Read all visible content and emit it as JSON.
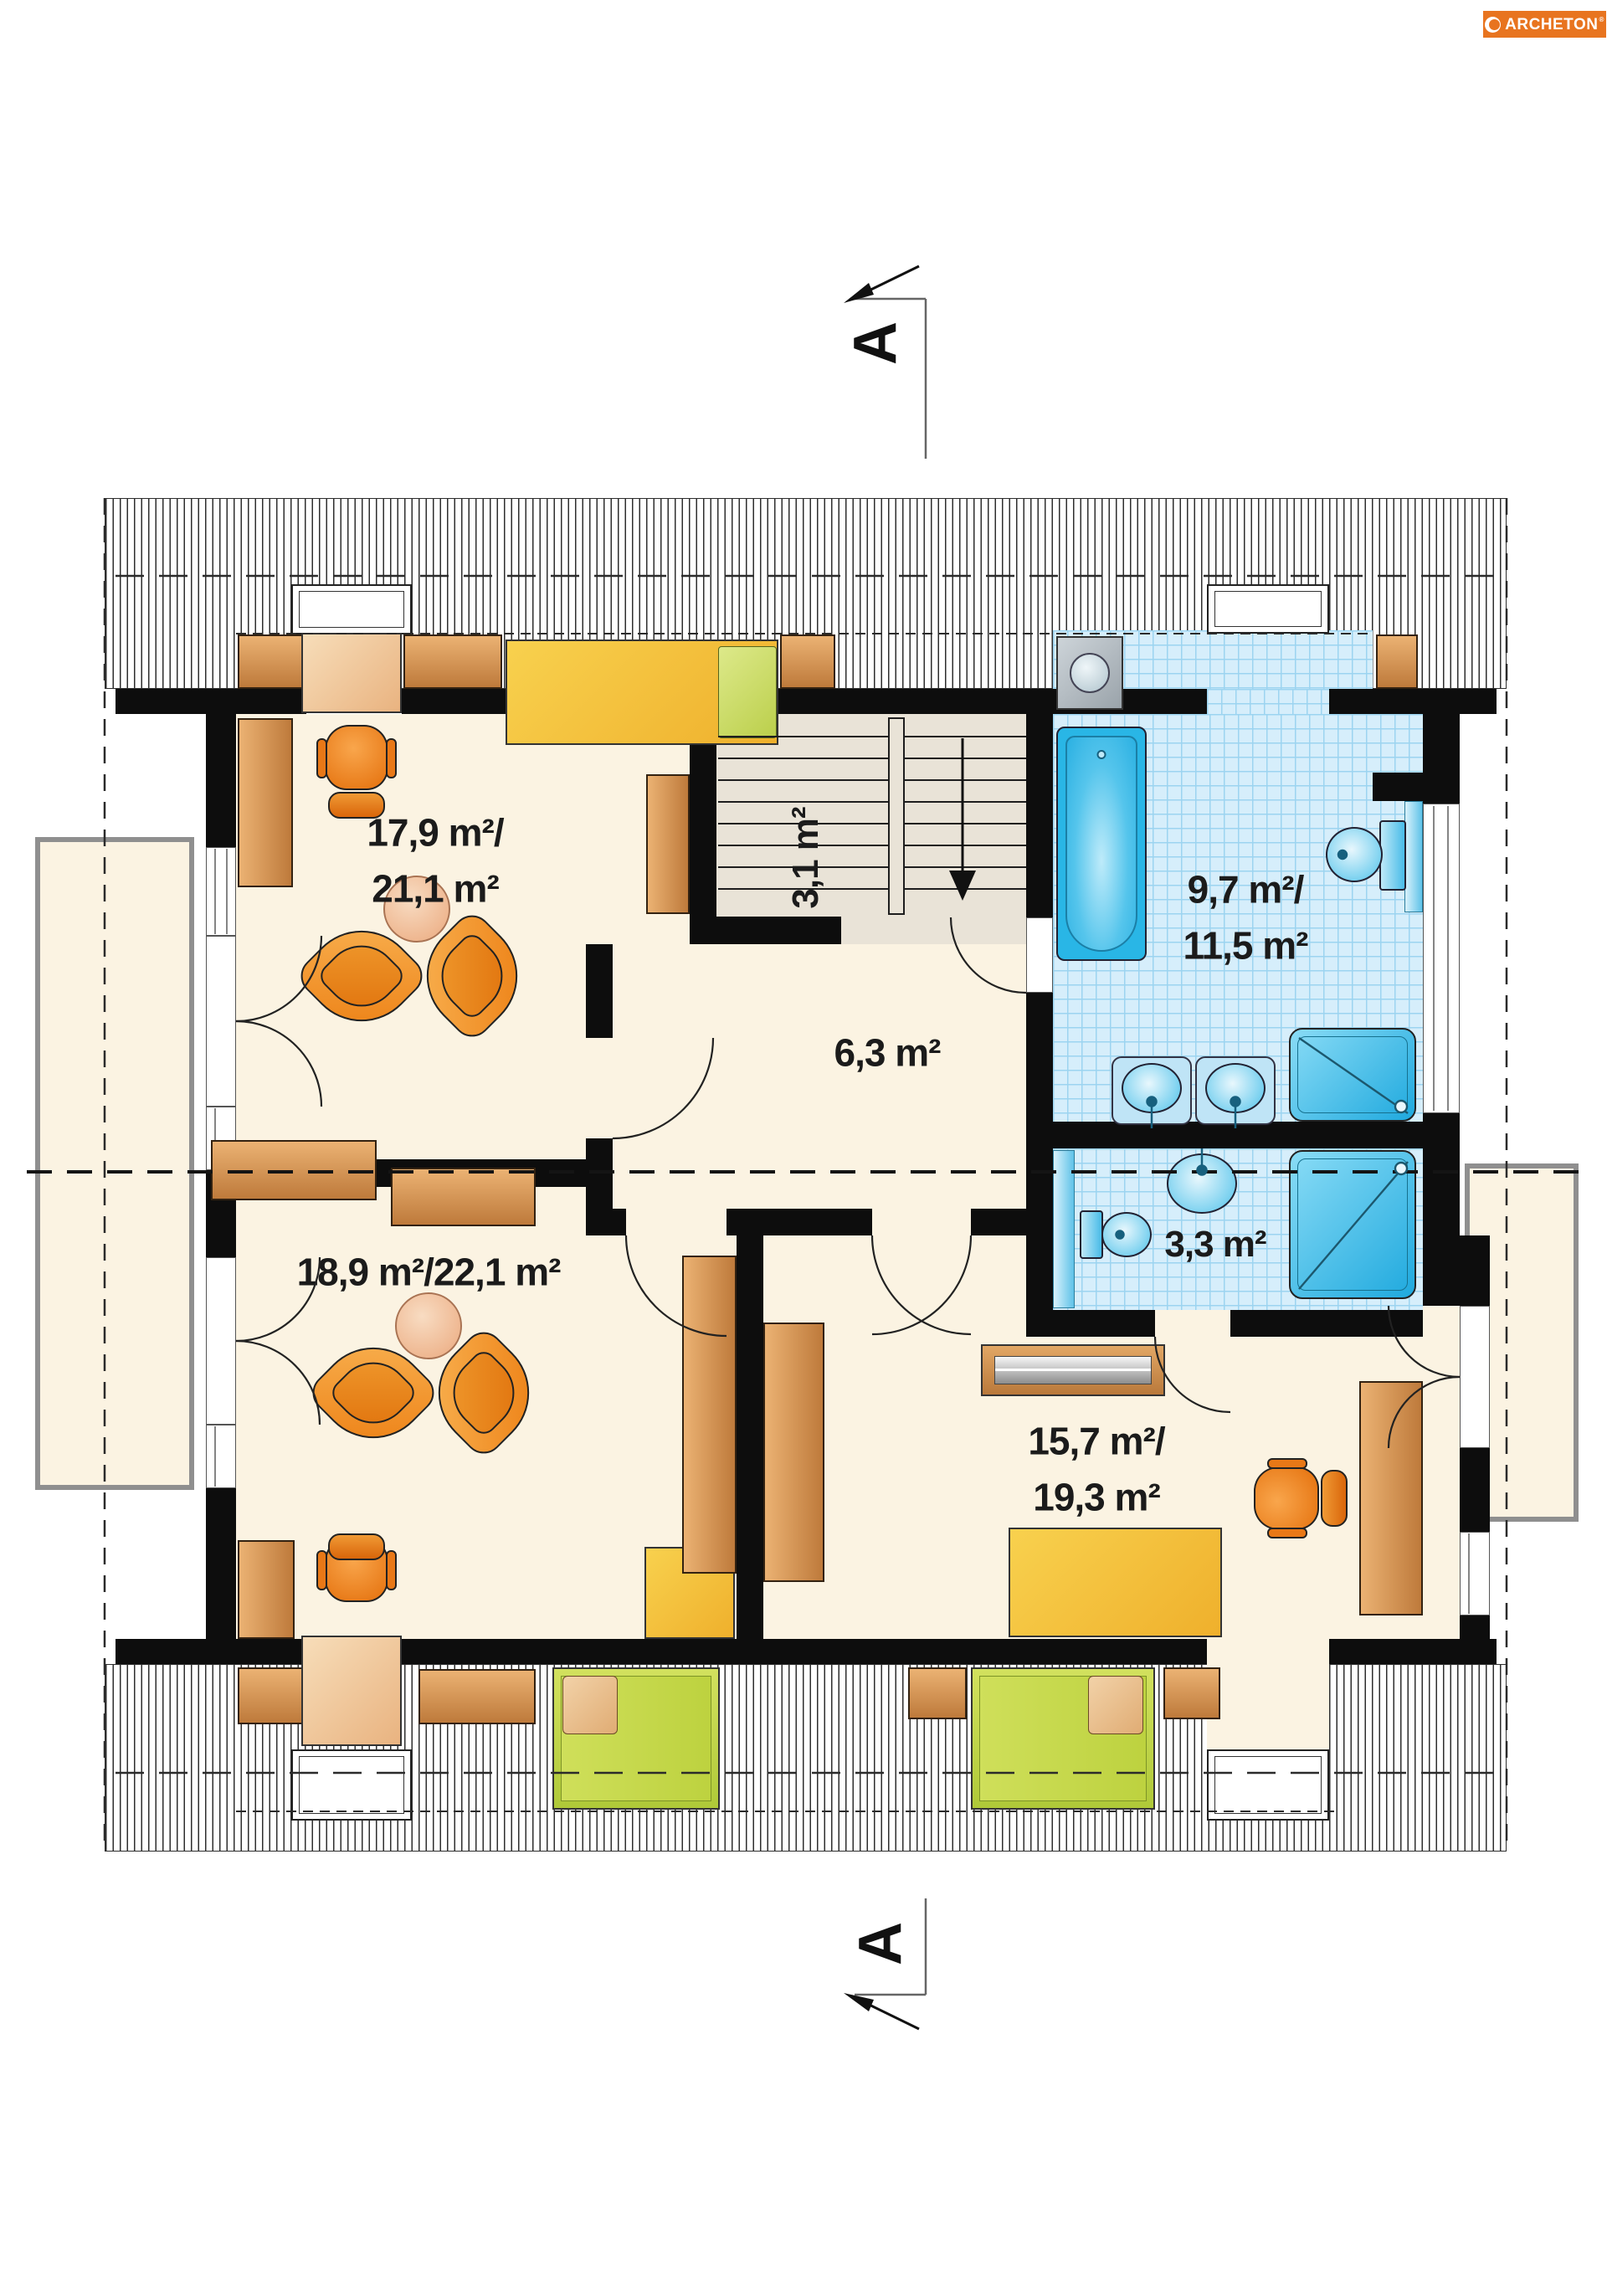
{
  "brand": {
    "name": "ARCHETON",
    "registered": "®"
  },
  "section_marker": {
    "letter": "A"
  },
  "rooms": {
    "bedroom_top_left": {
      "line1": "17,9 m²/",
      "line2": "21,1 m²"
    },
    "staircase": {
      "area": "3,1 m²"
    },
    "hall": {
      "area": "6,3 m²"
    },
    "bathroom": {
      "line1": "9,7 m²/",
      "line2": "11,5 m²"
    },
    "wc": {
      "area": "3,3 m²"
    },
    "bedroom_bottom_left": {
      "area": "18,9 m²/22,1 m²"
    },
    "bedroom_bottom_right": {
      "line1": "15,7 m²/",
      "line2": "19,3 m²"
    }
  },
  "colors": {
    "logo_orange": "#E8741F",
    "wall_black": "#0D0D0D",
    "floor_cream": "#FBF3E2",
    "tile_blue": "#D6EEFB",
    "fixture_blue": "#2AB4E6",
    "furniture_orange": "#EE7D1A",
    "wood_brown": "#C98A4D",
    "bed_yellow": "#F5C63E",
    "bed_green": "#C3D94E"
  }
}
